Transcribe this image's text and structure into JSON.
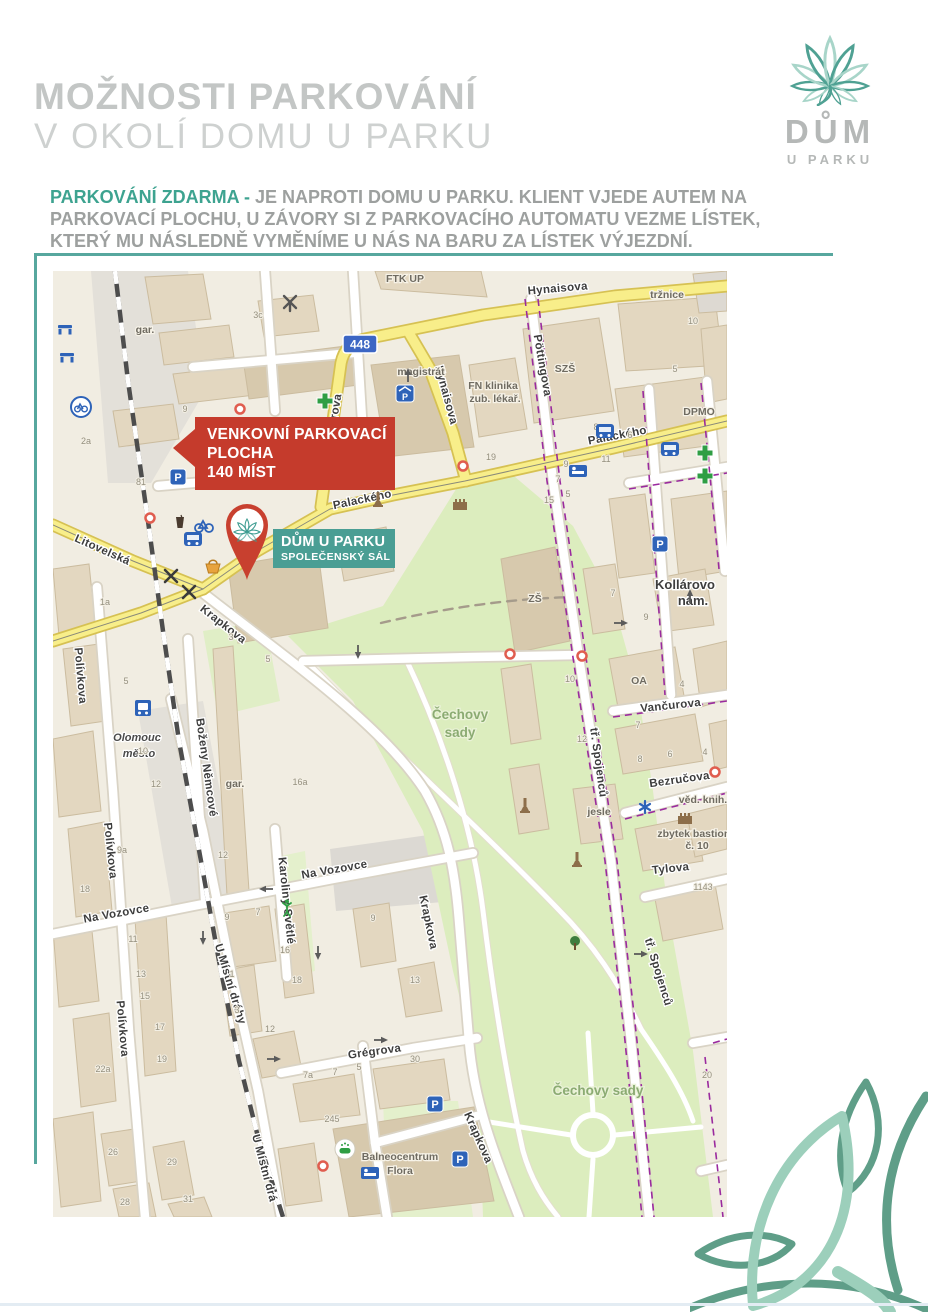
{
  "page": {
    "title_line1": "MOŽNOSTI PARKOVÁNÍ",
    "title_line2": "V OKOLÍ DOMU U PARKU"
  },
  "logo": {
    "name": "DŮM",
    "subname": "U PARKU"
  },
  "intro": {
    "highlight": "PARKOVÁNÍ ZDARMA -",
    "line1": "JE NAPROTI DOMU U PARKU. KLIENT VJEDE AUTEM NA",
    "line2": "PARKOVACÍ PLOCHU, U ZÁVORY SI Z PARKOVACÍHO AUTOMATU VEZME LÍSTEK,",
    "line3": "KTERÝ MU NÁSLEDNĚ VYMĚNÍME U NÁS NA BARU ZA LÍSTEK VÝJEZDNÍ."
  },
  "colors": {
    "teal": "#3da390",
    "teal_rule": "#57a79e",
    "red_callout": "#c53b2c",
    "venue_label": "#4a9e94",
    "title_gray": "#c3c6c5"
  },
  "callouts": {
    "parking": {
      "line1": "VENKOVNÍ PARKOVACÍ",
      "line2": "PLOCHA",
      "line3": "140 MÍST"
    },
    "venue": {
      "line1": "DŮM U PARKU",
      "line2": "SPOLEČENSKÝ SÁL"
    }
  },
  "map": {
    "route_badge": "448",
    "street_labels": [
      {
        "text": "Hynaisova",
        "x": 505,
        "y": 21,
        "rot": -5,
        "cls": "street"
      },
      {
        "text": "Hynaisova",
        "x": 390,
        "y": 125,
        "rot": 75,
        "cls": "street"
      },
      {
        "text": "Wellnerova",
        "x": 283,
        "y": 155,
        "rot": -80,
        "cls": "street"
      },
      {
        "text": "Pöttingova",
        "x": 486,
        "y": 95,
        "rot": 80,
        "cls": "street"
      },
      {
        "text": "Palackého",
        "x": 310,
        "y": 232,
        "rot": -12,
        "cls": "street"
      },
      {
        "text": "Palackého",
        "x": 565,
        "y": 168,
        "rot": -11,
        "cls": "street"
      },
      {
        "text": "Litovelská",
        "x": 48,
        "y": 282,
        "rot": 24,
        "cls": "street"
      },
      {
        "text": "Krapkova",
        "x": 168,
        "y": 356,
        "rot": 38,
        "cls": "street"
      },
      {
        "text": "Krapkova",
        "x": 372,
        "y": 652,
        "rot": 78,
        "cls": "street"
      },
      {
        "text": "Krapkova",
        "x": 422,
        "y": 868,
        "rot": 66,
        "cls": "street"
      },
      {
        "text": "Polívkova",
        "x": 24,
        "y": 405,
        "rot": 85,
        "cls": "street"
      },
      {
        "text": "Polívkova",
        "x": 54,
        "y": 580,
        "rot": 84,
        "cls": "street"
      },
      {
        "text": "Polívkova",
        "x": 66,
        "y": 758,
        "rot": 85,
        "cls": "street"
      },
      {
        "text": "Boženy Němcové",
        "x": 150,
        "y": 497,
        "rot": 82,
        "cls": "street"
      },
      {
        "text": "Karoliny Světlé",
        "x": 230,
        "y": 630,
        "rot": 84,
        "cls": "street"
      },
      {
        "text": "Na Vozovce",
        "x": 64,
        "y": 646,
        "rot": -10,
        "cls": "street"
      },
      {
        "text": "Na Vozovce",
        "x": 282,
        "y": 602,
        "rot": -10,
        "cls": "street"
      },
      {
        "text": "U Místní dráhy",
        "x": 174,
        "y": 714,
        "rot": 73,
        "cls": "street"
      },
      {
        "text": "U Místní drá",
        "x": 208,
        "y": 898,
        "rot": 75,
        "cls": "street"
      },
      {
        "text": "Grégrova",
        "x": 322,
        "y": 784,
        "rot": -8,
        "cls": "street"
      },
      {
        "text": "tř. Spojenců",
        "x": 542,
        "y": 492,
        "rot": 82,
        "cls": "street"
      },
      {
        "text": "tř. Spojenců",
        "x": 602,
        "y": 702,
        "rot": 73,
        "cls": "street"
      },
      {
        "text": "Vančurova",
        "x": 618,
        "y": 438,
        "rot": -6,
        "cls": "street"
      },
      {
        "text": "Bezručova",
        "x": 627,
        "y": 512,
        "rot": -8,
        "cls": "street"
      },
      {
        "text": "Tylova",
        "x": 618,
        "y": 601,
        "rot": -6,
        "cls": "street"
      },
      {
        "text": "Kollárovo",
        "x": 632,
        "y": 318,
        "rot": 0,
        "cls": "street-lg"
      },
      {
        "text": "nám.",
        "x": 640,
        "y": 334,
        "rot": 0,
        "cls": "street-lg"
      }
    ],
    "area_labels": [
      {
        "text": "Čechovy",
        "x": 407,
        "y": 448,
        "cls": "park-label"
      },
      {
        "text": "sady",
        "x": 407,
        "y": 466,
        "cls": "park-label"
      },
      {
        "text": "Čechovy sady",
        "x": 545,
        "y": 824,
        "cls": "park-label"
      },
      {
        "text": "Olomouc",
        "x": 84,
        "y": 470,
        "cls": "station"
      },
      {
        "text": "město",
        "x": 86,
        "y": 486,
        "cls": "station"
      },
      {
        "text": "tržnice",
        "x": 614,
        "y": 27,
        "cls": "area"
      },
      {
        "text": "magistrát",
        "x": 368,
        "y": 104,
        "cls": "area"
      },
      {
        "text": "FTK UP",
        "x": 352,
        "y": 11,
        "cls": "area"
      },
      {
        "text": "FN klinika",
        "x": 440,
        "y": 118,
        "cls": "area"
      },
      {
        "text": "zub. lékař.",
        "x": 442,
        "y": 131,
        "cls": "area"
      },
      {
        "text": "SZŠ",
        "x": 512,
        "y": 101,
        "cls": "area"
      },
      {
        "text": "ZŠ",
        "x": 482,
        "y": 331,
        "cls": "area"
      },
      {
        "text": "OA",
        "x": 586,
        "y": 413,
        "cls": "area"
      },
      {
        "text": "DPMO",
        "x": 646,
        "y": 144,
        "cls": "area"
      },
      {
        "text": "jesle",
        "x": 546,
        "y": 544,
        "cls": "area"
      },
      {
        "text": "věd. knih.",
        "x": 650,
        "y": 532,
        "cls": "area"
      },
      {
        "text": "zbytek bastionu",
        "x": 644,
        "y": 566,
        "cls": "area"
      },
      {
        "text": "č. 10",
        "x": 644,
        "y": 578,
        "cls": "area"
      },
      {
        "text": "Balneocentrum",
        "x": 347,
        "y": 889,
        "cls": "area"
      },
      {
        "text": "Flora",
        "x": 347,
        "y": 903,
        "cls": "area"
      },
      {
        "text": "gar.",
        "x": 92,
        "y": 62,
        "cls": "area"
      },
      {
        "text": "gar.",
        "x": 182,
        "y": 516,
        "cls": "area"
      }
    ],
    "house_numbers": [
      {
        "text": "3c",
        "x": 205,
        "y": 47
      },
      {
        "text": "9",
        "x": 132,
        "y": 141
      },
      {
        "text": "81",
        "x": 88,
        "y": 214
      },
      {
        "text": "22",
        "x": 168,
        "y": 214
      },
      {
        "text": "2a",
        "x": 33,
        "y": 173
      },
      {
        "text": "10",
        "x": 640,
        "y": 53
      },
      {
        "text": "5",
        "x": 622,
        "y": 101
      },
      {
        "text": "8",
        "x": 543,
        "y": 159
      },
      {
        "text": "6",
        "x": 577,
        "y": 167
      },
      {
        "text": "19",
        "x": 438,
        "y": 189
      },
      {
        "text": "11",
        "x": 553,
        "y": 191
      },
      {
        "text": "9",
        "x": 513,
        "y": 196
      },
      {
        "text": "7",
        "x": 505,
        "y": 211
      },
      {
        "text": "5",
        "x": 515,
        "y": 226
      },
      {
        "text": "15",
        "x": 496,
        "y": 232
      },
      {
        "text": "1a",
        "x": 52,
        "y": 334
      },
      {
        "text": "5",
        "x": 73,
        "y": 413
      },
      {
        "text": "10",
        "x": 90,
        "y": 483
      },
      {
        "text": "12",
        "x": 103,
        "y": 516
      },
      {
        "text": "3",
        "x": 178,
        "y": 369
      },
      {
        "text": "5",
        "x": 215,
        "y": 391
      },
      {
        "text": "7",
        "x": 560,
        "y": 325
      },
      {
        "text": "9",
        "x": 593,
        "y": 349
      },
      {
        "text": "10",
        "x": 517,
        "y": 411
      },
      {
        "text": "12",
        "x": 529,
        "y": 471
      },
      {
        "text": "4",
        "x": 629,
        "y": 416
      },
      {
        "text": "7",
        "x": 585,
        "y": 457
      },
      {
        "text": "8",
        "x": 587,
        "y": 491
      },
      {
        "text": "6",
        "x": 617,
        "y": 486
      },
      {
        "text": "4",
        "x": 652,
        "y": 484
      },
      {
        "text": "9a",
        "x": 69,
        "y": 582
      },
      {
        "text": "18",
        "x": 32,
        "y": 621
      },
      {
        "text": "11",
        "x": 80,
        "y": 671
      },
      {
        "text": "13",
        "x": 88,
        "y": 706
      },
      {
        "text": "15",
        "x": 92,
        "y": 728
      },
      {
        "text": "17",
        "x": 107,
        "y": 759
      },
      {
        "text": "19",
        "x": 109,
        "y": 791
      },
      {
        "text": "22a",
        "x": 50,
        "y": 801
      },
      {
        "text": "12",
        "x": 170,
        "y": 587
      },
      {
        "text": "9",
        "x": 174,
        "y": 649
      },
      {
        "text": "7",
        "x": 205,
        "y": 644
      },
      {
        "text": "16a",
        "x": 247,
        "y": 514
      },
      {
        "text": "16",
        "x": 232,
        "y": 682
      },
      {
        "text": "18",
        "x": 244,
        "y": 712
      },
      {
        "text": "1",
        "x": 179,
        "y": 706
      },
      {
        "text": "3",
        "x": 184,
        "y": 742
      },
      {
        "text": "12",
        "x": 217,
        "y": 761
      },
      {
        "text": "9",
        "x": 320,
        "y": 650
      },
      {
        "text": "13",
        "x": 362,
        "y": 712
      },
      {
        "text": "5",
        "x": 306,
        "y": 799
      },
      {
        "text": "7",
        "x": 282,
        "y": 804
      },
      {
        "text": "7a",
        "x": 255,
        "y": 807
      },
      {
        "text": "30",
        "x": 362,
        "y": 791
      },
      {
        "text": "245",
        "x": 279,
        "y": 851
      },
      {
        "text": "26",
        "x": 60,
        "y": 884
      },
      {
        "text": "29",
        "x": 119,
        "y": 894
      },
      {
        "text": "28",
        "x": 72,
        "y": 934
      },
      {
        "text": "31",
        "x": 135,
        "y": 931
      },
      {
        "text": "20",
        "x": 654,
        "y": 807
      },
      {
        "text": "1143",
        "x": 650,
        "y": 619
      }
    ],
    "pois": [
      {
        "type": "bench",
        "x": 12,
        "y": 58
      },
      {
        "type": "bench",
        "x": 14,
        "y": 86
      },
      {
        "type": "bikeshare",
        "x": 28,
        "y": 136
      },
      {
        "type": "parking",
        "x": 125,
        "y": 206
      },
      {
        "type": "parking-roof",
        "x": 352,
        "y": 122
      },
      {
        "type": "parking",
        "x": 607,
        "y": 273
      },
      {
        "type": "parking",
        "x": 382,
        "y": 833
      },
      {
        "type": "parking",
        "x": 407,
        "y": 888
      },
      {
        "type": "tram",
        "x": 140,
        "y": 268
      },
      {
        "type": "tram",
        "x": 552,
        "y": 160
      },
      {
        "type": "tram",
        "x": 617,
        "y": 178
      },
      {
        "type": "cup",
        "x": 127,
        "y": 252
      },
      {
        "type": "bike",
        "x": 151,
        "y": 254
      },
      {
        "type": "basket",
        "x": 160,
        "y": 296
      },
      {
        "type": "restaurant",
        "x": 118,
        "y": 305
      },
      {
        "type": "restaurant",
        "x": 136,
        "y": 321
      },
      {
        "type": "windmill",
        "x": 237,
        "y": 32
      },
      {
        "type": "pharmacy",
        "x": 272,
        "y": 130
      },
      {
        "type": "pharmacy",
        "x": 652,
        "y": 182
      },
      {
        "type": "pharmacy",
        "x": 652,
        "y": 205
      },
      {
        "type": "bed",
        "x": 525,
        "y": 200
      },
      {
        "type": "bed",
        "x": 317,
        "y": 902
      },
      {
        "type": "train",
        "x": 90,
        "y": 437
      },
      {
        "type": "monument",
        "x": 325,
        "y": 230
      },
      {
        "type": "monument",
        "x": 524,
        "y": 590
      },
      {
        "type": "monument",
        "x": 472,
        "y": 536
      },
      {
        "type": "castle",
        "x": 407,
        "y": 233
      },
      {
        "type": "castle",
        "x": 632,
        "y": 547
      },
      {
        "type": "tree",
        "x": 522,
        "y": 673
      },
      {
        "type": "playground",
        "x": 234,
        "y": 638
      },
      {
        "type": "bath",
        "x": 292,
        "y": 878
      },
      {
        "type": "star",
        "x": 592,
        "y": 536
      },
      {
        "type": "barrier",
        "x": 187,
        "y": 138
      },
      {
        "type": "barrier",
        "x": 410,
        "y": 195
      },
      {
        "type": "barrier",
        "x": 457,
        "y": 383
      },
      {
        "type": "barrier",
        "x": 529,
        "y": 385
      },
      {
        "type": "barrier",
        "x": 270,
        "y": 895
      },
      {
        "type": "barrier",
        "x": 662,
        "y": 501
      },
      {
        "type": "barrier",
        "x": 97,
        "y": 247
      },
      {
        "type": "arrow",
        "x": 305,
        "y": 380,
        "rot": 90
      },
      {
        "type": "arrow",
        "x": 567,
        "y": 352,
        "rot": 0
      },
      {
        "type": "arrow",
        "x": 637,
        "y": 326,
        "rot": -90
      },
      {
        "type": "arrow",
        "x": 150,
        "y": 666,
        "rot": 90
      },
      {
        "type": "arrow",
        "x": 214,
        "y": 618,
        "rot": 180
      },
      {
        "type": "arrow",
        "x": 265,
        "y": 681,
        "rot": 90
      },
      {
        "type": "arrow",
        "x": 220,
        "y": 788,
        "rot": 0
      },
      {
        "type": "arrow",
        "x": 327,
        "y": 769,
        "rot": 0
      },
      {
        "type": "arrow",
        "x": 587,
        "y": 683,
        "rot": 0
      },
      {
        "type": "arrow",
        "x": 355,
        "y": 105,
        "rot": -90
      }
    ]
  }
}
